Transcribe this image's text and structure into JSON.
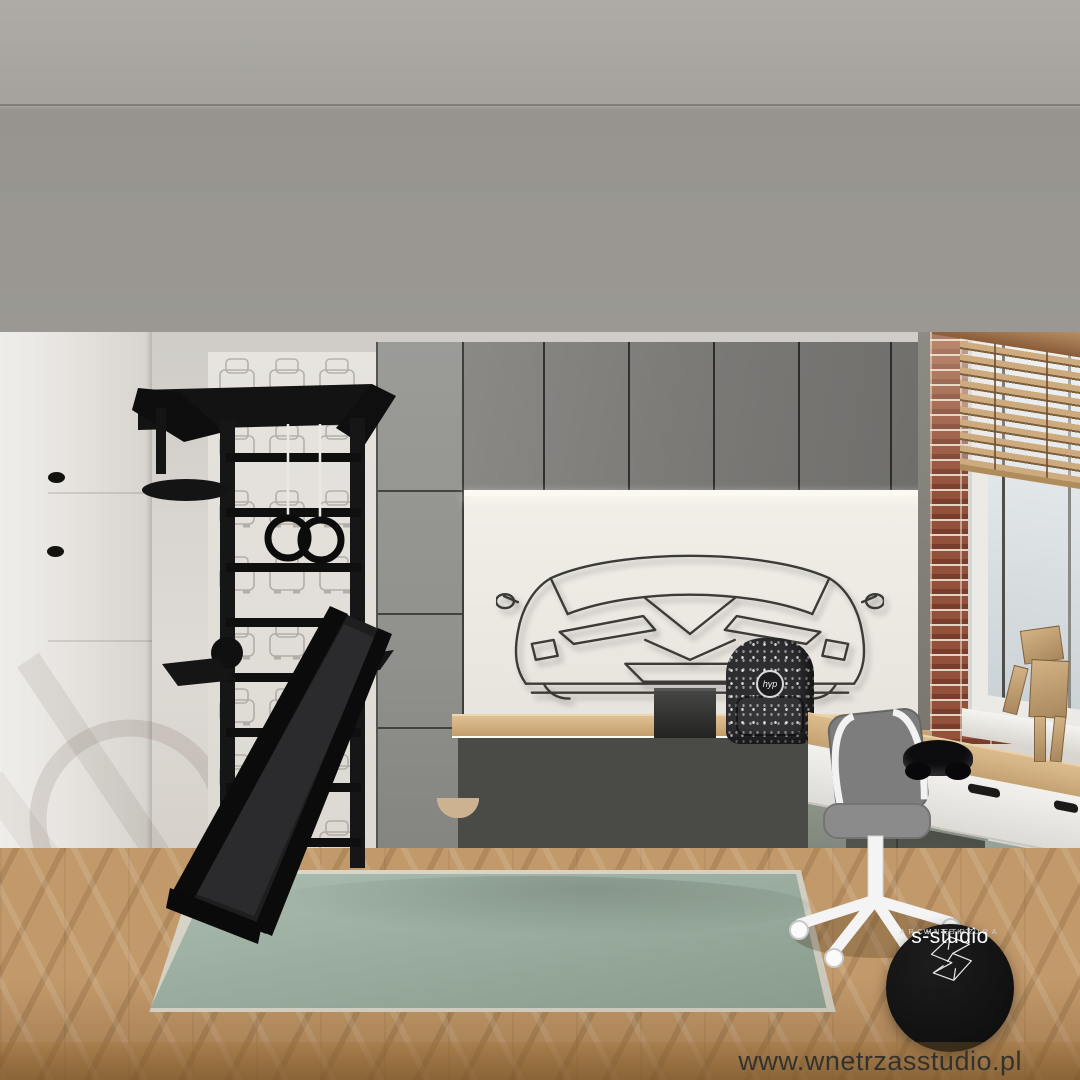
{
  "branding": {
    "logo_title": "s-studio",
    "logo_subtitle_line1": "ARCHITEKTURA",
    "logo_subtitle_line2": "WNĘTRZ",
    "website": "www.wnetrzasstudio.pl"
  },
  "backpack": {
    "logo_text": "hyp"
  },
  "palette": {
    "ceiling": "#a5a29d",
    "back_wall": "#d8d5d0",
    "niche_wall": "#edeae5",
    "upper_cabinet_gray": "#7b7a77",
    "tall_cabinet_gray": "#90908c",
    "counter_wood": "#c9a472",
    "front_wood": "#c7ae92",
    "sage_drawer": "#8b9a8d",
    "rug_sage": "#9fb2a4",
    "floor_wood": "#c2996a",
    "brick_red": "#93503a",
    "steel_black": "#151515",
    "chair_seat_gray": "#858585",
    "chair_frame_white": "#f3f3f3",
    "blinds_wood": "#cdab7e"
  }
}
